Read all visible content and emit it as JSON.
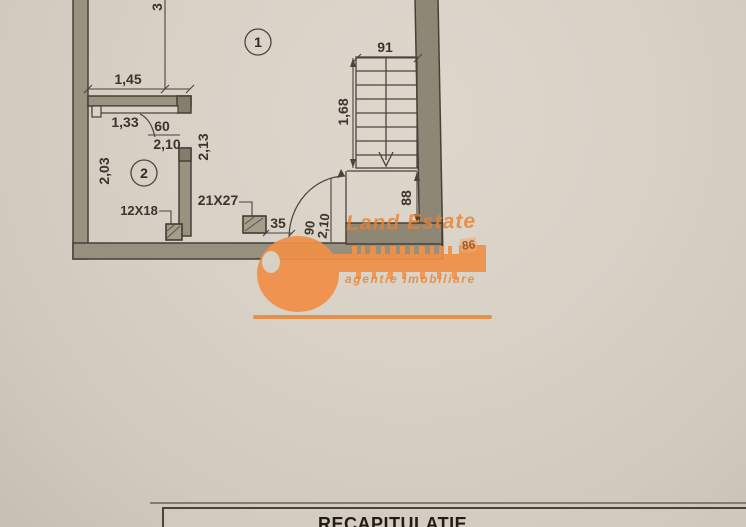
{
  "floorplan": {
    "rooms": [
      {
        "number": "1"
      },
      {
        "number": "2"
      }
    ],
    "dims": {
      "top_cut": "3",
      "w145": "1,45",
      "w133": "1,33",
      "door2_w": "60",
      "door2_h": "2,10",
      "hall_h": "2,13",
      "room2_h": "2,03",
      "flue_small": "12X18",
      "flue_large": "21X27",
      "seg35": "35",
      "stair_w": "91",
      "stair_l": "1,68",
      "lobby_d": "88",
      "door1_w": "90",
      "door1_h": "2,10"
    }
  },
  "watermark": {
    "brand": "Land Estate",
    "tagline": "agentie imobiliare",
    "badge": "86",
    "accent_color": "#ef8c44"
  },
  "recap": {
    "title": "RECAPITULATIE"
  }
}
